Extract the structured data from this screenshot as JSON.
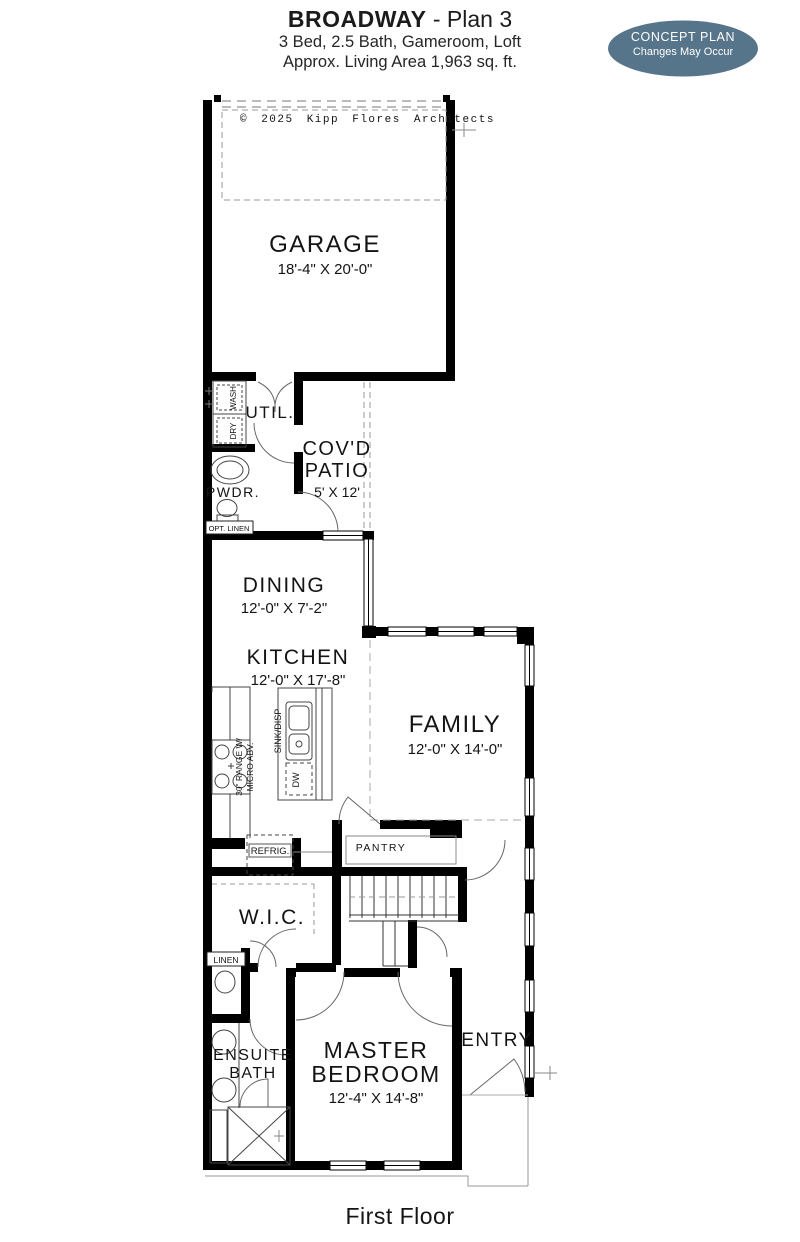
{
  "header": {
    "title_bold": "BROADWAY",
    "title_rest": " - Plan 3",
    "subtitle_line1": "3 Bed, 2.5 Bath, Gameroom, Loft",
    "subtitle_line2": "Approx. Living Area 1,963 sq. ft."
  },
  "badge": {
    "line1": "CONCEPT PLAN",
    "line2": "Changes May Occur",
    "bg_color": "#56748a",
    "text_color": "#ffffff"
  },
  "plan": {
    "copyright": "© 2025 Kipp Flores Architects",
    "colors": {
      "wall": "#000000",
      "dash": "#999999"
    },
    "rooms": {
      "garage": {
        "name": "GARAGE",
        "dims": "18'-4\" X 20'-0\""
      },
      "util": {
        "name": "UTIL."
      },
      "covd_patio": {
        "name_line1": "COV'D",
        "name_line2": "PATIO",
        "dims": "5' X 12'"
      },
      "pwdr": {
        "name": "PWDR."
      },
      "dining": {
        "name": "DINING",
        "dims": "12'-0\" X 7'-2\""
      },
      "kitchen": {
        "name": "KITCHEN",
        "dims": "12'-0\" X 17'-8\""
      },
      "family": {
        "name": "FAMILY",
        "dims": "12'-0\" X 14'-0\""
      },
      "wic": {
        "name": "W.I.C."
      },
      "pantry": {
        "name": "PANTRY"
      },
      "ensuite": {
        "name_line1": "ENSUITE",
        "name_line2": "BATH"
      },
      "master": {
        "name_line1": "MASTER",
        "name_line2": "BEDROOM",
        "dims": "12'-4\" X 14'-8\""
      },
      "entry": {
        "name": "ENTRY"
      }
    },
    "fixtures": {
      "wash": "WASH",
      "dry": "DRY",
      "opt_linen": "OPT. LINEN",
      "linen": "LINEN",
      "refrig": "REFRIG.",
      "range_line1": "30\" RANGE W/",
      "range_line2": "MICRO ABV.",
      "sink": "SINK/DISP",
      "dw": "DW"
    }
  },
  "footer": {
    "label": "First Floor"
  }
}
